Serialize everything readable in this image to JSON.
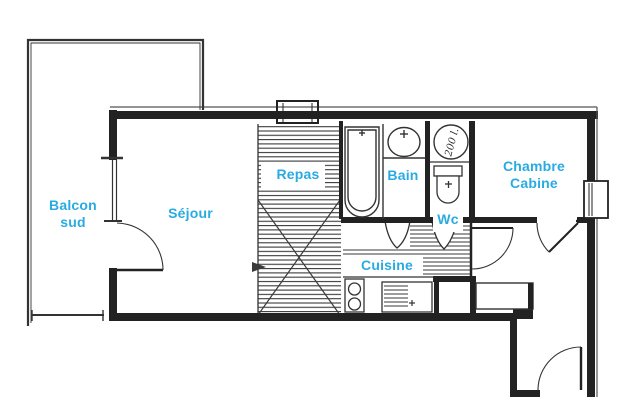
{
  "colors": {
    "label_text": "#29ABE2",
    "line": "#222222",
    "background": "#FFFFFF"
  },
  "rooms": {
    "balcony": {
      "line1": "Balcon",
      "line2": "sud"
    },
    "living_room": {
      "label": "Séjour"
    },
    "dining_area": {
      "label": "Repas"
    },
    "bathroom": {
      "label": "Bain"
    },
    "toilet": {
      "label": "Wc"
    },
    "kitchen": {
      "label": "Cuisine"
    },
    "bedroom": {
      "line1": "Chambre",
      "line2": "Cabine"
    }
  },
  "annotations": {
    "water_heater_capacity": "200 l."
  }
}
